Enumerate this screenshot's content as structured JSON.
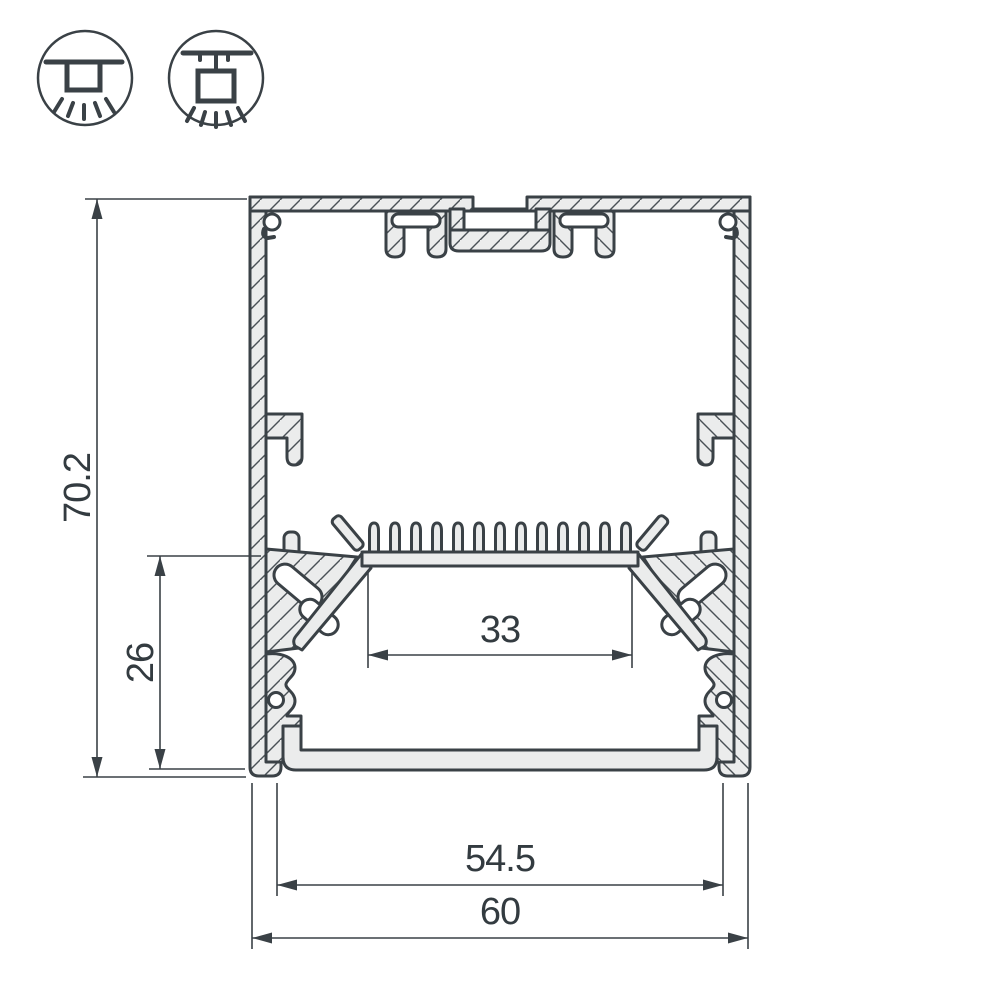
{
  "title": "LED aluminium profile cross-section technical drawing",
  "icons": {
    "surface": {
      "name": "surface-mount-luminaire-icon"
    },
    "pendant": {
      "name": "pendant-mount-luminaire-icon"
    }
  },
  "dimensions": {
    "overall_height": "70.2",
    "lower_cavity_height": "26",
    "led_platform_width": "33",
    "diffuser_width": "54.5",
    "overall_width": "60"
  },
  "colors": {
    "line": "#3a4146",
    "metal_fill": "#ebecec",
    "text": "#333b40",
    "background": "#ffffff"
  }
}
